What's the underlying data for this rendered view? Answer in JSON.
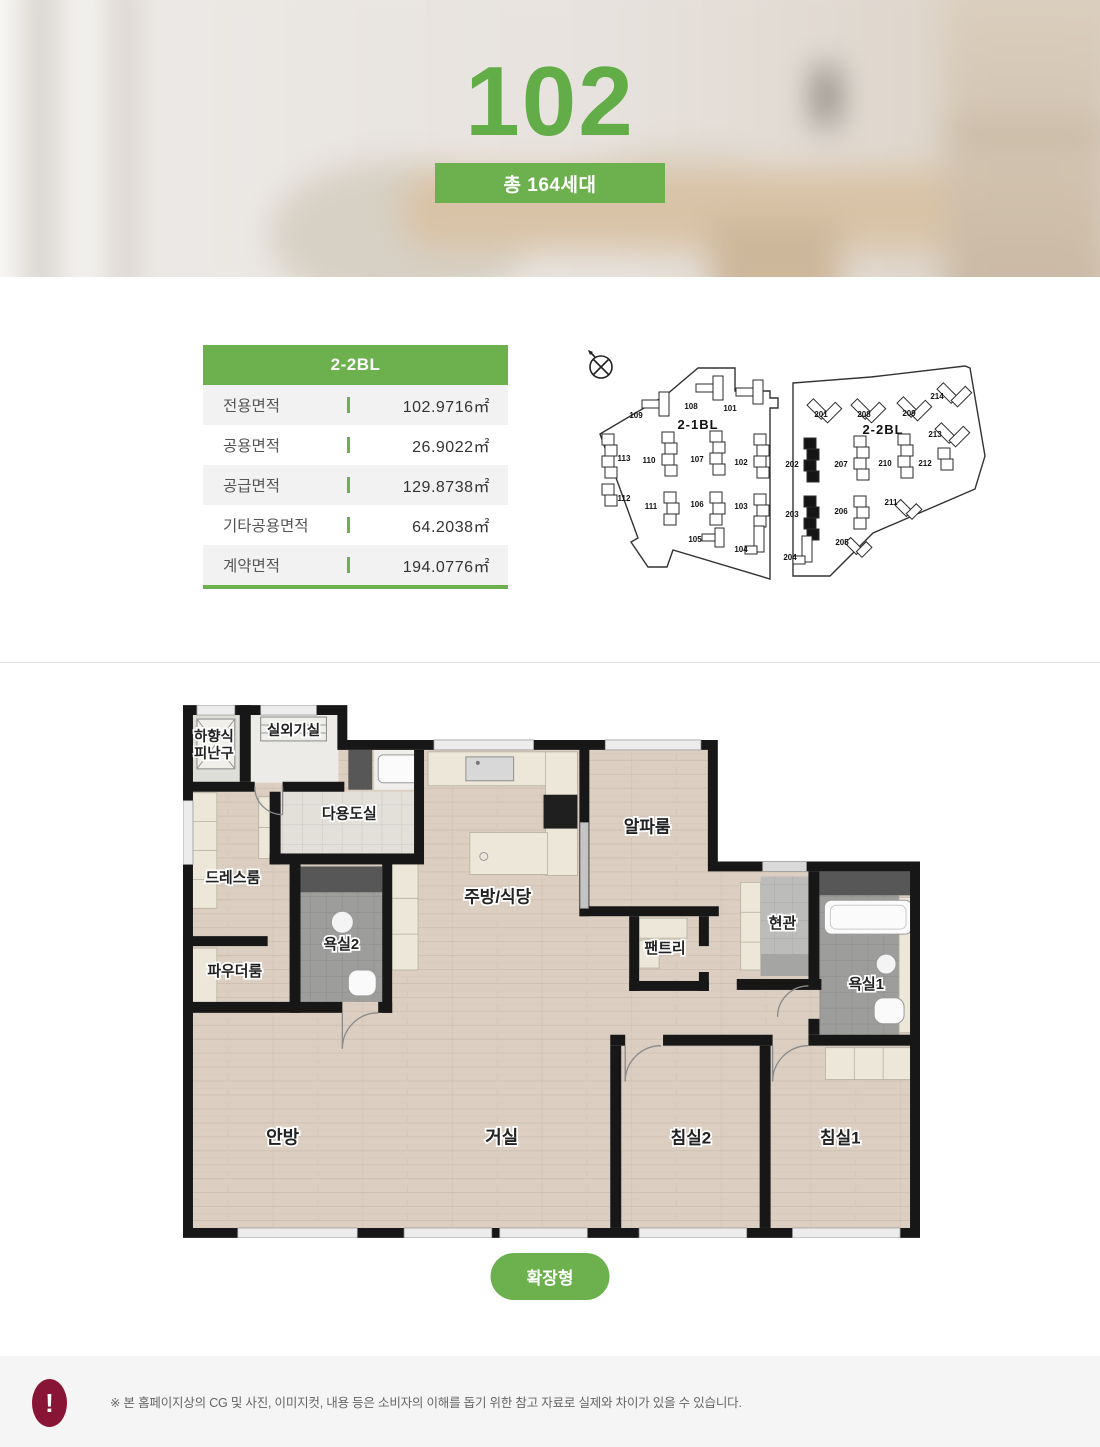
{
  "hero": {
    "unit_number": "102",
    "badge_label": "총 164세대"
  },
  "area_table": {
    "header": "2-2BL",
    "rows": [
      {
        "label": "전용면적",
        "value": "102.9716㎡"
      },
      {
        "label": "공용면적",
        "value": "26.9022㎡"
      },
      {
        "label": "공급면적",
        "value": "129.8738㎡"
      },
      {
        "label": "기타공용면적",
        "value": "64.2038㎡"
      },
      {
        "label": "계약면적",
        "value": "194.0776㎡"
      }
    ]
  },
  "site_plan": {
    "compass": "north-compass-icon",
    "highlighted_buildings": [
      "202",
      "203"
    ],
    "blocks": [
      {
        "name": "2-1BL",
        "name_pos": [
          120,
          83
        ],
        "outline": "M22,88 L88,49 L120,22 L157,22 L157,45 L192,45 L192,52 L200,52 L200,62 L192,62 L192,233 L95,204 L89,221 L70,221 L53,196 L60,192 Z",
        "buildings": [
          {
            "id": "109",
            "kind": "LH",
            "glyph": [
              64,
              46
            ],
            "label": [
              58,
              72
            ]
          },
          {
            "id": "108",
            "kind": "LH",
            "glyph": [
              118,
              30
            ],
            "label": [
              113,
              63
            ]
          },
          {
            "id": "101",
            "kind": "LH",
            "glyph": [
              158,
              34
            ],
            "label": [
              152,
              65
            ]
          },
          {
            "id": "113",
            "kind": "col4",
            "glyph": [
              24,
              88
            ],
            "label": [
              46,
              115
            ]
          },
          {
            "id": "110",
            "kind": "col4",
            "glyph": [
              84,
              86
            ],
            "label": [
              71,
              117
            ]
          },
          {
            "id": "107",
            "kind": "col4",
            "glyph": [
              132,
              85
            ],
            "label": [
              119,
              116
            ]
          },
          {
            "id": "102",
            "kind": "col4",
            "glyph": [
              176,
              88
            ],
            "label": [
              163,
              119
            ]
          },
          {
            "id": "112",
            "kind": "col2",
            "glyph": [
              24,
              138
            ],
            "label": [
              46,
              155
            ]
          },
          {
            "id": "111",
            "kind": "col3",
            "glyph": [
              86,
              146
            ],
            "label": [
              73,
              163
            ]
          },
          {
            "id": "106",
            "kind": "col3",
            "glyph": [
              132,
              146
            ],
            "label": [
              119,
              161
            ]
          },
          {
            "id": "103",
            "kind": "col3",
            "glyph": [
              176,
              148
            ],
            "label": [
              163,
              163
            ]
          },
          {
            "id": "105",
            "kind": "LHs",
            "glyph": [
              124,
              182
            ],
            "label": [
              117,
              196
            ]
          },
          {
            "id": "104",
            "kind": "LV",
            "glyph": [
              176,
              180
            ],
            "label": [
              163,
              206
            ]
          }
        ]
      },
      {
        "name": "2-2BL",
        "name_pos": [
          305,
          88
        ],
        "outline": "M215,37 L293,31 L387,20 L392,22 L407,110 L397,143 L295,187 L252,230 L215,230 Z",
        "buildings": [
          {
            "id": "201",
            "kind": "diag",
            "glyph": [
              236,
              48
            ],
            "label": [
              243,
              71
            ]
          },
          {
            "id": "208",
            "kind": "diag",
            "glyph": [
              280,
              48
            ],
            "label": [
              286,
              71
            ]
          },
          {
            "id": "209",
            "kind": "diag",
            "glyph": [
              326,
              46
            ],
            "label": [
              331,
              70
            ]
          },
          {
            "id": "214",
            "kind": "diag",
            "glyph": [
              366,
              32
            ],
            "label": [
              359,
              53
            ]
          },
          {
            "id": "213",
            "kind": "diag",
            "glyph": [
              364,
              72
            ],
            "label": [
              357,
              91
            ]
          },
          {
            "id": "202",
            "kind": "col4",
            "glyph": [
              226,
              92
            ],
            "filled": true,
            "label": [
              214,
              121
            ]
          },
          {
            "id": "207",
            "kind": "col4",
            "glyph": [
              276,
              90
            ],
            "label": [
              263,
              121
            ]
          },
          {
            "id": "210",
            "kind": "col4",
            "glyph": [
              320,
              88
            ],
            "label": [
              307,
              120
            ]
          },
          {
            "id": "212",
            "kind": "col2",
            "glyph": [
              360,
              102
            ],
            "label": [
              347,
              120
            ]
          },
          {
            "id": "203",
            "kind": "col4",
            "glyph": [
              226,
              150
            ],
            "filled": true,
            "label": [
              214,
              171
            ]
          },
          {
            "id": "206",
            "kind": "col3",
            "glyph": [
              276,
              150
            ],
            "label": [
              263,
              168
            ]
          },
          {
            "id": "211",
            "kind": "diagS",
            "glyph": [
              324,
              148
            ],
            "label": [
              313,
              159
            ]
          },
          {
            "id": "204",
            "kind": "LV",
            "glyph": [
              224,
              190
            ],
            "label": [
              212,
              214
            ]
          },
          {
            "id": "205",
            "kind": "diagS",
            "glyph": [
              274,
              186
            ],
            "label": [
              264,
              199
            ]
          }
        ]
      }
    ]
  },
  "floor_plan": {
    "rooms": [
      {
        "id": "escape-hatch",
        "label": "하향식\n피난구",
        "pos": [
          31,
          36
        ],
        "size": 14.5
      },
      {
        "id": "ac-room",
        "label": "실외기실",
        "pos": [
          111,
          30
        ],
        "size": 14.5
      },
      {
        "id": "utility-room",
        "label": "다용도실",
        "pos": [
          167,
          114
        ],
        "size": 15
      },
      {
        "id": "dress-room",
        "label": "드레스룸",
        "pos": [
          50,
          178
        ],
        "size": 15
      },
      {
        "id": "powder-room",
        "label": "파우더룸",
        "pos": [
          52,
          272
        ],
        "size": 15
      },
      {
        "id": "bath2",
        "label": "욕실2",
        "pos": [
          159,
          245
        ],
        "size": 15
      },
      {
        "id": "kitchen-dining",
        "label": "주방/식당",
        "pos": [
          316,
          198
        ],
        "size": 17
      },
      {
        "id": "alpha-room",
        "label": "알파룸",
        "pos": [
          466,
          128
        ],
        "size": 17
      },
      {
        "id": "pantry",
        "label": "팬트리",
        "pos": [
          484,
          249
        ],
        "size": 15
      },
      {
        "id": "entrance",
        "label": "현관",
        "pos": [
          602,
          224
        ],
        "size": 15
      },
      {
        "id": "bath1",
        "label": "욕실1",
        "pos": [
          686,
          285
        ],
        "size": 15
      },
      {
        "id": "master-bedroom",
        "label": "안방",
        "pos": [
          100,
          440
        ],
        "size": 18
      },
      {
        "id": "living-room",
        "label": "거실",
        "pos": [
          320,
          440
        ],
        "size": 18
      },
      {
        "id": "bedroom2",
        "label": "침실2",
        "pos": [
          510,
          440
        ],
        "size": 17
      },
      {
        "id": "bedroom1",
        "label": "침실1",
        "pos": [
          660,
          440
        ],
        "size": 17
      }
    ],
    "expand_button": "확장형"
  },
  "notice": {
    "icon": "!",
    "text": "※ 본 홈페이지상의 CG 및 사진, 이미지컷, 내용 등은 소비자의 이해를 돕기 위한 참고 자료로 실제와 차이가 있을 수 있습니다."
  },
  "colors": {
    "accent_green": "#6cb14d",
    "notice_red": "#891536",
    "wall_black": "#171717"
  }
}
